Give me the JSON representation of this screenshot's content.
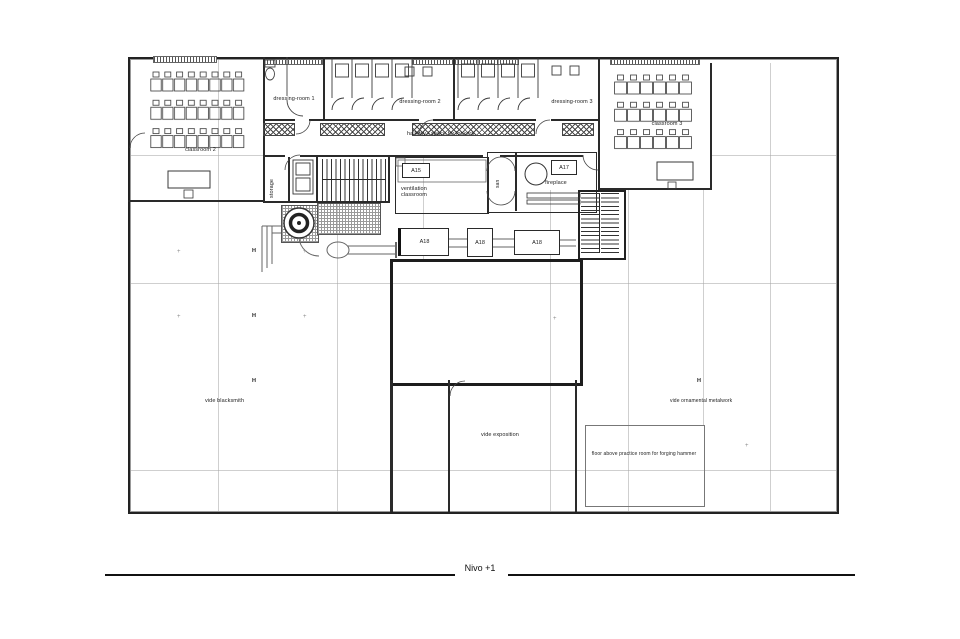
{
  "sheet": {
    "title": "Nivo +1"
  },
  "rooms": {
    "classroom2": "classroom 2",
    "dressing_room_1": "dressing-room 1",
    "dressing_room_2": "dressing-room 2",
    "dressing_room_3": "dressing-room 3",
    "hallway": "hallway / space for lockers",
    "classroom3": "classroom 3",
    "storage": "storage",
    "ventilation_classroom": "ventilation classroom",
    "san": "san",
    "fireplace": "fireplace",
    "vide_blacksmith": "vide blacksmith",
    "vide_exposition": "vide exposition",
    "vide_ornamental_metalwork": "vide ornamental metalwork",
    "floor_above": "floor above practice room for forging hammer"
  },
  "tags": {
    "a15": "A15",
    "a17": "A17",
    "a18_left": "A18",
    "a18_mid": "A18",
    "a18_right": "A18"
  },
  "markers": {
    "column": "H",
    "cross": "+"
  }
}
